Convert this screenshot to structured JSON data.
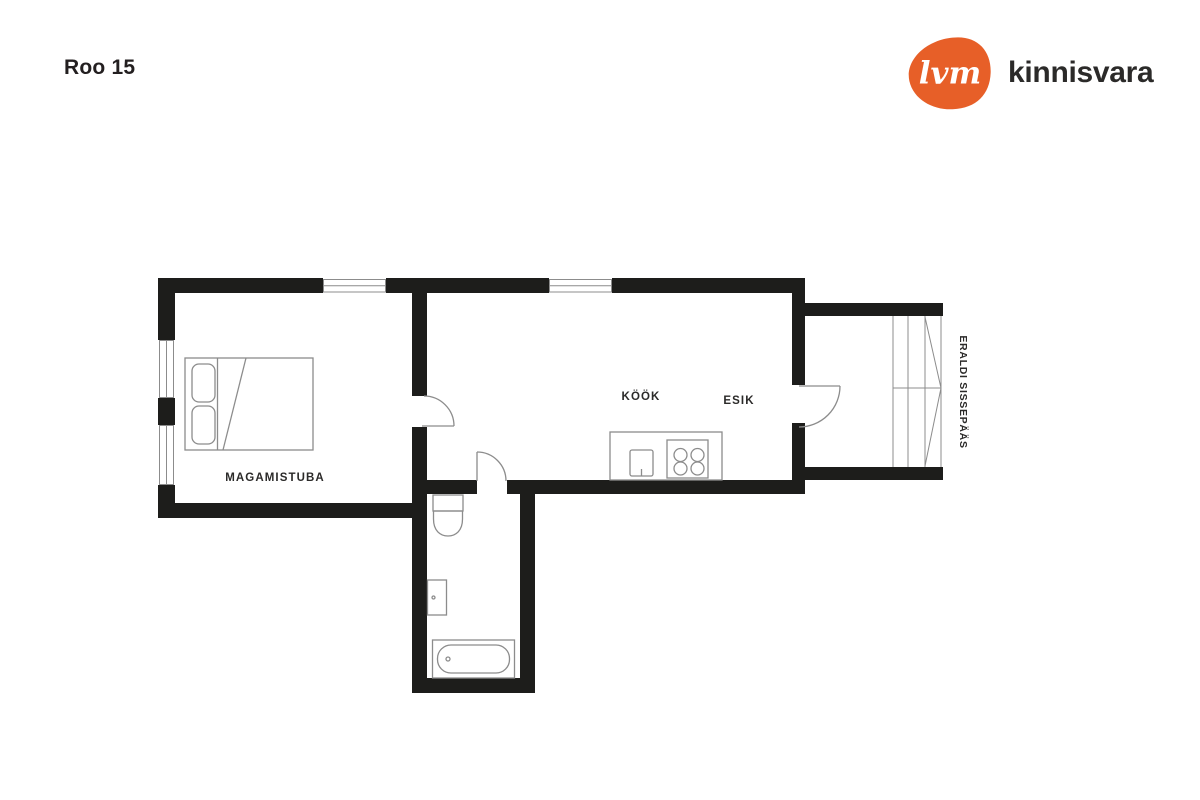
{
  "page_title": "Roo 15",
  "brand": {
    "mark_text": "lvm",
    "name": "kinnisvara",
    "mark_color": "#e75f28",
    "name_color": "#2b2a29"
  },
  "floorplan": {
    "wall_color": "#1d1d1b",
    "line_color": "#8c8c8c",
    "label_color": "#2b2a29",
    "labels": {
      "bedroom": "MAGAMISTUBA",
      "kitchen": "KÖÖK",
      "hallway": "ESIK",
      "separate_entrance": "ERALDI SISSEPÄÄS"
    }
  }
}
